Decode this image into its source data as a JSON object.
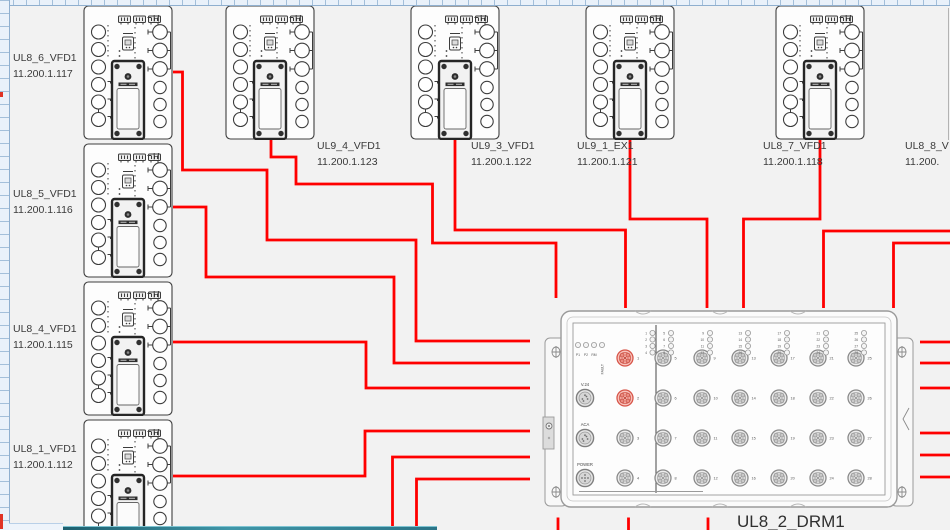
{
  "canvas": {
    "background": "#f2f2f2"
  },
  "colors": {
    "wire": "#ff0000",
    "outline": "#3c3c3c",
    "label_text": "#3a3a3a",
    "port_highlight": "#d85549"
  },
  "vfd": {
    "corner_label": "H"
  },
  "devices": [
    {
      "name": "UL8_6_VFD1",
      "ip": "11.200.1.117"
    },
    {
      "name": "UL8_5_VFD1",
      "ip": "11.200.1.116"
    },
    {
      "name": "UL8_4_VFD1",
      "ip": "11.200.1.115"
    },
    {
      "name": "UL8_1_VFD1",
      "ip": "11.200.1.112"
    },
    {
      "name": "UL9_4_VFD1",
      "ip": "11.200.1.123"
    },
    {
      "name": "UL9_3_VFD1",
      "ip": "11.200.1.122"
    },
    {
      "name": "UL9_1_EX1",
      "ip": "11.200.1.121"
    },
    {
      "name": "UL8_7_VFD1",
      "ip": "11.200.1.118"
    },
    {
      "name": "UL8_8_V",
      "ip": "11.200."
    }
  ],
  "switch": {
    "label": "UL8_2_DRM1",
    "status_leds": [
      "P1",
      "P2",
      "RM",
      "FAULT"
    ],
    "aux_ports": [
      "V.24",
      "ACA",
      "POWER"
    ],
    "numbered_ports": [
      "1",
      "2",
      "3",
      "4"
    ],
    "highlighted_ports": [
      "1",
      "2"
    ],
    "port_columns": [
      [
        "5",
        "6",
        "7",
        "8"
      ],
      [
        "9",
        "10",
        "11",
        "12"
      ],
      [
        "13",
        "14",
        "15",
        "16"
      ],
      [
        "17",
        "18",
        "19",
        "20"
      ],
      [
        "21",
        "22",
        "23",
        "24"
      ],
      [
        "25",
        "26",
        "27",
        "28"
      ]
    ]
  }
}
